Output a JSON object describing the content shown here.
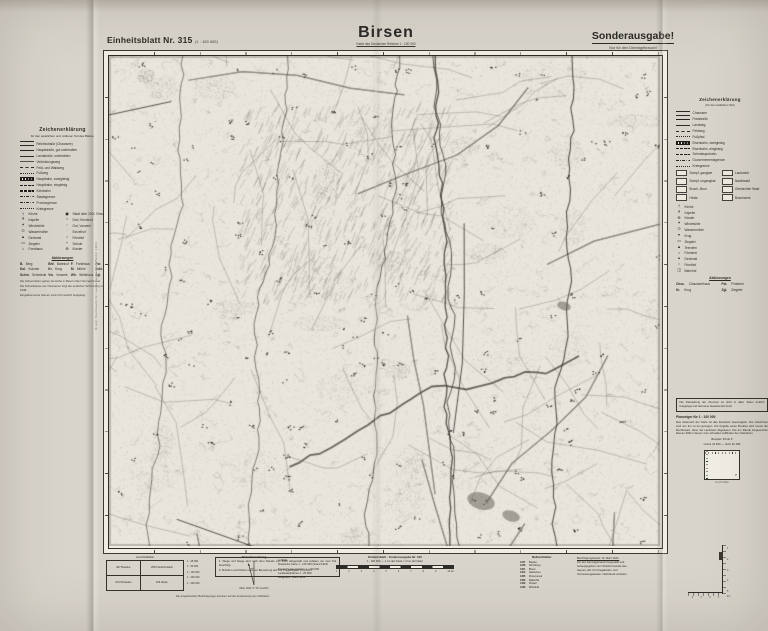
{
  "header": {
    "sheet_label": "Einheitsblatt Nr. 315",
    "sheet_note": "(1 : 100 000)",
    "title": "Birsen",
    "title_sub": "Karte des Deutschen Reiches 1 : 100 000",
    "special": "Sonderausgabe!",
    "special_sub": "Nur für den Dienstgebrauch!"
  },
  "left_legend": {
    "title": "Zeichenerklärung",
    "subtitle": "für den westlichen und mittleren Teil des Blattes",
    "rows": [
      {
        "s": "sw-double",
        "t": "Reichsstraße (Chaussee)"
      },
      {
        "s": "sw-thick",
        "t": "Hauptstraße, gut unterhalten"
      },
      {
        "s": "sw-solid",
        "t": "Landstraße, unterhalten"
      },
      {
        "s": "sw-thin",
        "t": "Verbindungsweg"
      },
      {
        "s": "sw-dash",
        "t": "Feld- und Waldweg"
      },
      {
        "s": "sw-dot",
        "t": "Fußweg"
      },
      {
        "s": "sw-rail2",
        "t": "Hauptbahn, zweigleisig"
      },
      {
        "s": "sw-rail1",
        "t": "Hauptbahn, eingleisig"
      },
      {
        "s": "sw-rail1",
        "t": "Kleinbahn"
      },
      {
        "s": "sw-dashdot",
        "t": "Staatsgrenze"
      },
      {
        "s": "sw-dashdot",
        "t": "Provinzgrenze"
      },
      {
        "s": "sw-dot",
        "t": "Kreisgrenze"
      }
    ],
    "symbols_left": [
      {
        "g": "†",
        "t": "Kirche"
      },
      {
        "g": "✝",
        "t": "Kapelle"
      },
      {
        "g": "✶",
        "t": "Windmühle"
      },
      {
        "g": "⊙",
        "t": "Wassermühle"
      },
      {
        "g": "▲",
        "t": "Denkmal"
      },
      {
        "g": "▭",
        "t": "Ziegelei"
      },
      {
        "g": "⌂",
        "t": "Forsthaus"
      }
    ],
    "symbols_right": [
      {
        "g": "◼",
        "t": "Stadt über 2000 Einw."
      },
      {
        "g": "▪",
        "t": "Dorf, Kirchdorf"
      },
      {
        "g": "▫",
        "t": "Gut, Vorwerk"
      },
      {
        "g": "·",
        "t": "Einzelhof"
      },
      {
        "g": "○",
        "t": "Friedhof"
      },
      {
        "g": "+",
        "t": "Schule"
      },
      {
        "g": "⊕",
        "t": "Kloster"
      }
    ],
    "abk_title": "Abkürzungen",
    "abk": [
      [
        "B.",
        "Berg"
      ],
      [
        "Bhf.",
        "Bahnhof"
      ],
      [
        "F.",
        "Forsthaus"
      ],
      [
        "Fbr.",
        "Fabrik"
      ],
      [
        "Kol.",
        "Kolonie"
      ],
      [
        "Kr.",
        "Krug"
      ],
      [
        "M.",
        "Mühle"
      ],
      [
        "Schl.",
        "Schloß"
      ],
      [
        "Schm.",
        "Schmiede"
      ],
      [
        "Vw.",
        "Vorwerk"
      ],
      [
        "Wh.",
        "Wirtshaus"
      ],
      [
        "Zgl.",
        "Ziegelei"
      ]
    ],
    "footnotes": [
      "Die Höhenzahlen geben die Höhe in Metern über Normal-Null an.",
      "Die Schreibweise der Ortsnamen folgt der amtlichen Schreibung von 1938.",
      "Eingeklammerte Namen sind nicht amtlich festgelegt."
    ]
  },
  "right_legend": {
    "title": "Zeichenerklärung",
    "subtitle": "(für den östlichen Teil)",
    "rows": [
      {
        "s": "sw-double",
        "t": "Chaussee"
      },
      {
        "s": "sw-thick",
        "t": "Poststraße"
      },
      {
        "s": "sw-solid",
        "t": "Landweg"
      },
      {
        "s": "sw-dash",
        "t": "Feldweg"
      },
      {
        "s": "sw-dot",
        "t": "Fußpfad"
      },
      {
        "s": "sw-rail2",
        "t": "Eisenbahn, zweigleisig"
      },
      {
        "s": "sw-rail1",
        "t": "Eisenbahn, eingleisig"
      },
      {
        "s": "sw-rail1",
        "t": "Schmalspurbahn"
      },
      {
        "s": "sw-dashdot",
        "t": "Gouvernementsgrenze"
      },
      {
        "s": "sw-dot",
        "t": "Kreisgrenze"
      }
    ],
    "boxes": [
      "Sumpf, gangbar",
      "Laubwald",
      "Sumpf, ungangbar",
      "Nadelwald",
      "Bruch, Moor",
      "Gemischter Wald",
      "Heide",
      "Buschwerk"
    ],
    "points": [
      {
        "g": "†",
        "t": "Kirche"
      },
      {
        "g": "✝",
        "t": "Kapelle"
      },
      {
        "g": "⊕",
        "t": "Kloster"
      },
      {
        "g": "✶",
        "t": "Windmühle"
      },
      {
        "g": "⊙",
        "t": "Wassermühle"
      },
      {
        "g": "▾",
        "t": "Krug"
      },
      {
        "g": "▭",
        "t": "Ziegelei"
      },
      {
        "g": "▲",
        "t": "Teerofen"
      },
      {
        "g": "⌂",
        "t": "Försterei"
      },
      {
        "g": "▴",
        "t": "Denkmal"
      },
      {
        "g": "○",
        "t": "Friedhof"
      },
      {
        "g": "◫",
        "t": "Bahnhof"
      }
    ],
    "abk_title": "Abkürzungen",
    "abk": [
      [
        "Chss.",
        "Chausseehaus"
      ],
      [
        "Fst.",
        "Försterei"
      ],
      [
        "Kr.",
        "Krug"
      ],
      [
        "Zgl.",
        "Ziegelei"
      ]
    ]
  },
  "margins": {
    "left_vertical": "Druck: Reichsamt für Landesaufnahme, Berlin 1944",
    "right_vertical": "Nachdruck verboten — Sonderausgabe I/44"
  },
  "right_notes": {
    "box_text": "Die Darstellung der Grenzen ist nicht in allen Teilen amtlich festgelegt und hat keine beweisende Kraft.",
    "plan_title": "Planzeiger für 1 : 100 000",
    "plan_text": "Das Gitternetz der Karte ist das Deutsche Heeresgitter. Die Gitterlinien sind von km zu km gezogen. Zur Angabe eines Punktes wird zuerst der Rechtswert, dann der Hochwert abgelesen. Die am Rande beigesetzten kleinen Ziffern dienen zum schnellen Auffinden der Gitterlinien.",
    "example1": "Beispiel: Punkt P",
    "example2": "rechts 44 520 — hoch 62 180",
    "point_label": "P",
    "diagram_scale": "0   1   2   3   4 km"
  },
  "bottom": {
    "adjoining": {
      "caption": "Anschlußblätter",
      "cells": [
        "297 Bauske",
        "298 Friedrichstadt",
        "314 Schaulen",
        "316 Abele"
      ]
    },
    "editions": [
      "1 : 25 000",
      "1 : 50 000",
      "1 : 100 000",
      "1 : 200 000",
      "1 : 300 000"
    ],
    "notice": [
      "1. Wege und Stege sind nach dem Stande von 1915 dargestellt und seitdem nur zum Teil berichtigt.",
      "2. Brücken und Fähren sind vor Benutzung auf ihre Tragfähigkeit zu prüfen."
    ],
    "footnote": "Die eingedruckten Berichtigungen beruhen auf der Auswertung von Luftbildern.",
    "declination": {
      "title": "Nadelabweichung",
      "sub": "Mitte 1944: 6° 30′ westlich"
    },
    "sources": [
      "Luftbild:",
      "Russische Karte 1 : 126 000 (Stand 1915)",
      "Deutsche Heereskarte 1 : 100 000",
      "Landesaufnahme 1 : 25 000",
      "Wegenetz: Stand 1943"
    ],
    "scale": {
      "line1": "Einheitsblatt · Sonderausgabe Nr. 315",
      "line2": "1 : 100 000 — 1 cm der Karte = 1 km der Natur",
      "ticks": [
        "1",
        "2",
        "3",
        "4",
        "5",
        "6",
        "7",
        "8",
        "9",
        "10 km"
      ]
    },
    "msbl": {
      "title": "Meßtischblätter:",
      "rows": [
        [
          "1237",
          "Bauske"
        ],
        [
          "1238",
          "Schönberg"
        ],
        [
          "1301",
          "Birsen"
        ],
        [
          "1302",
          "Salotschen"
        ],
        [
          "1365",
          "Poniemunek"
        ],
        [
          "1366",
          "Rakischki"
        ],
        [
          "1429",
          "Poswol"
        ],
        [
          "1430",
          "Wobolniki"
        ]
      ]
    },
    "imprint": [
      "Berichtigungsstand: 10. März 1944.",
      "Für den Dienstgebrauch hergestellt und",
      "herausgegeben vom Oberkommando des",
      "Heeres, Abt. für Kriegskarten- und",
      "Vermessungswesen. Nachdruck verboten."
    ],
    "ruler": {
      "v": [
        "1",
        "2",
        "3",
        "4",
        "5"
      ],
      "h": [
        "4",
        "3",
        "2",
        "1"
      ],
      "unit": "km"
    }
  }
}
